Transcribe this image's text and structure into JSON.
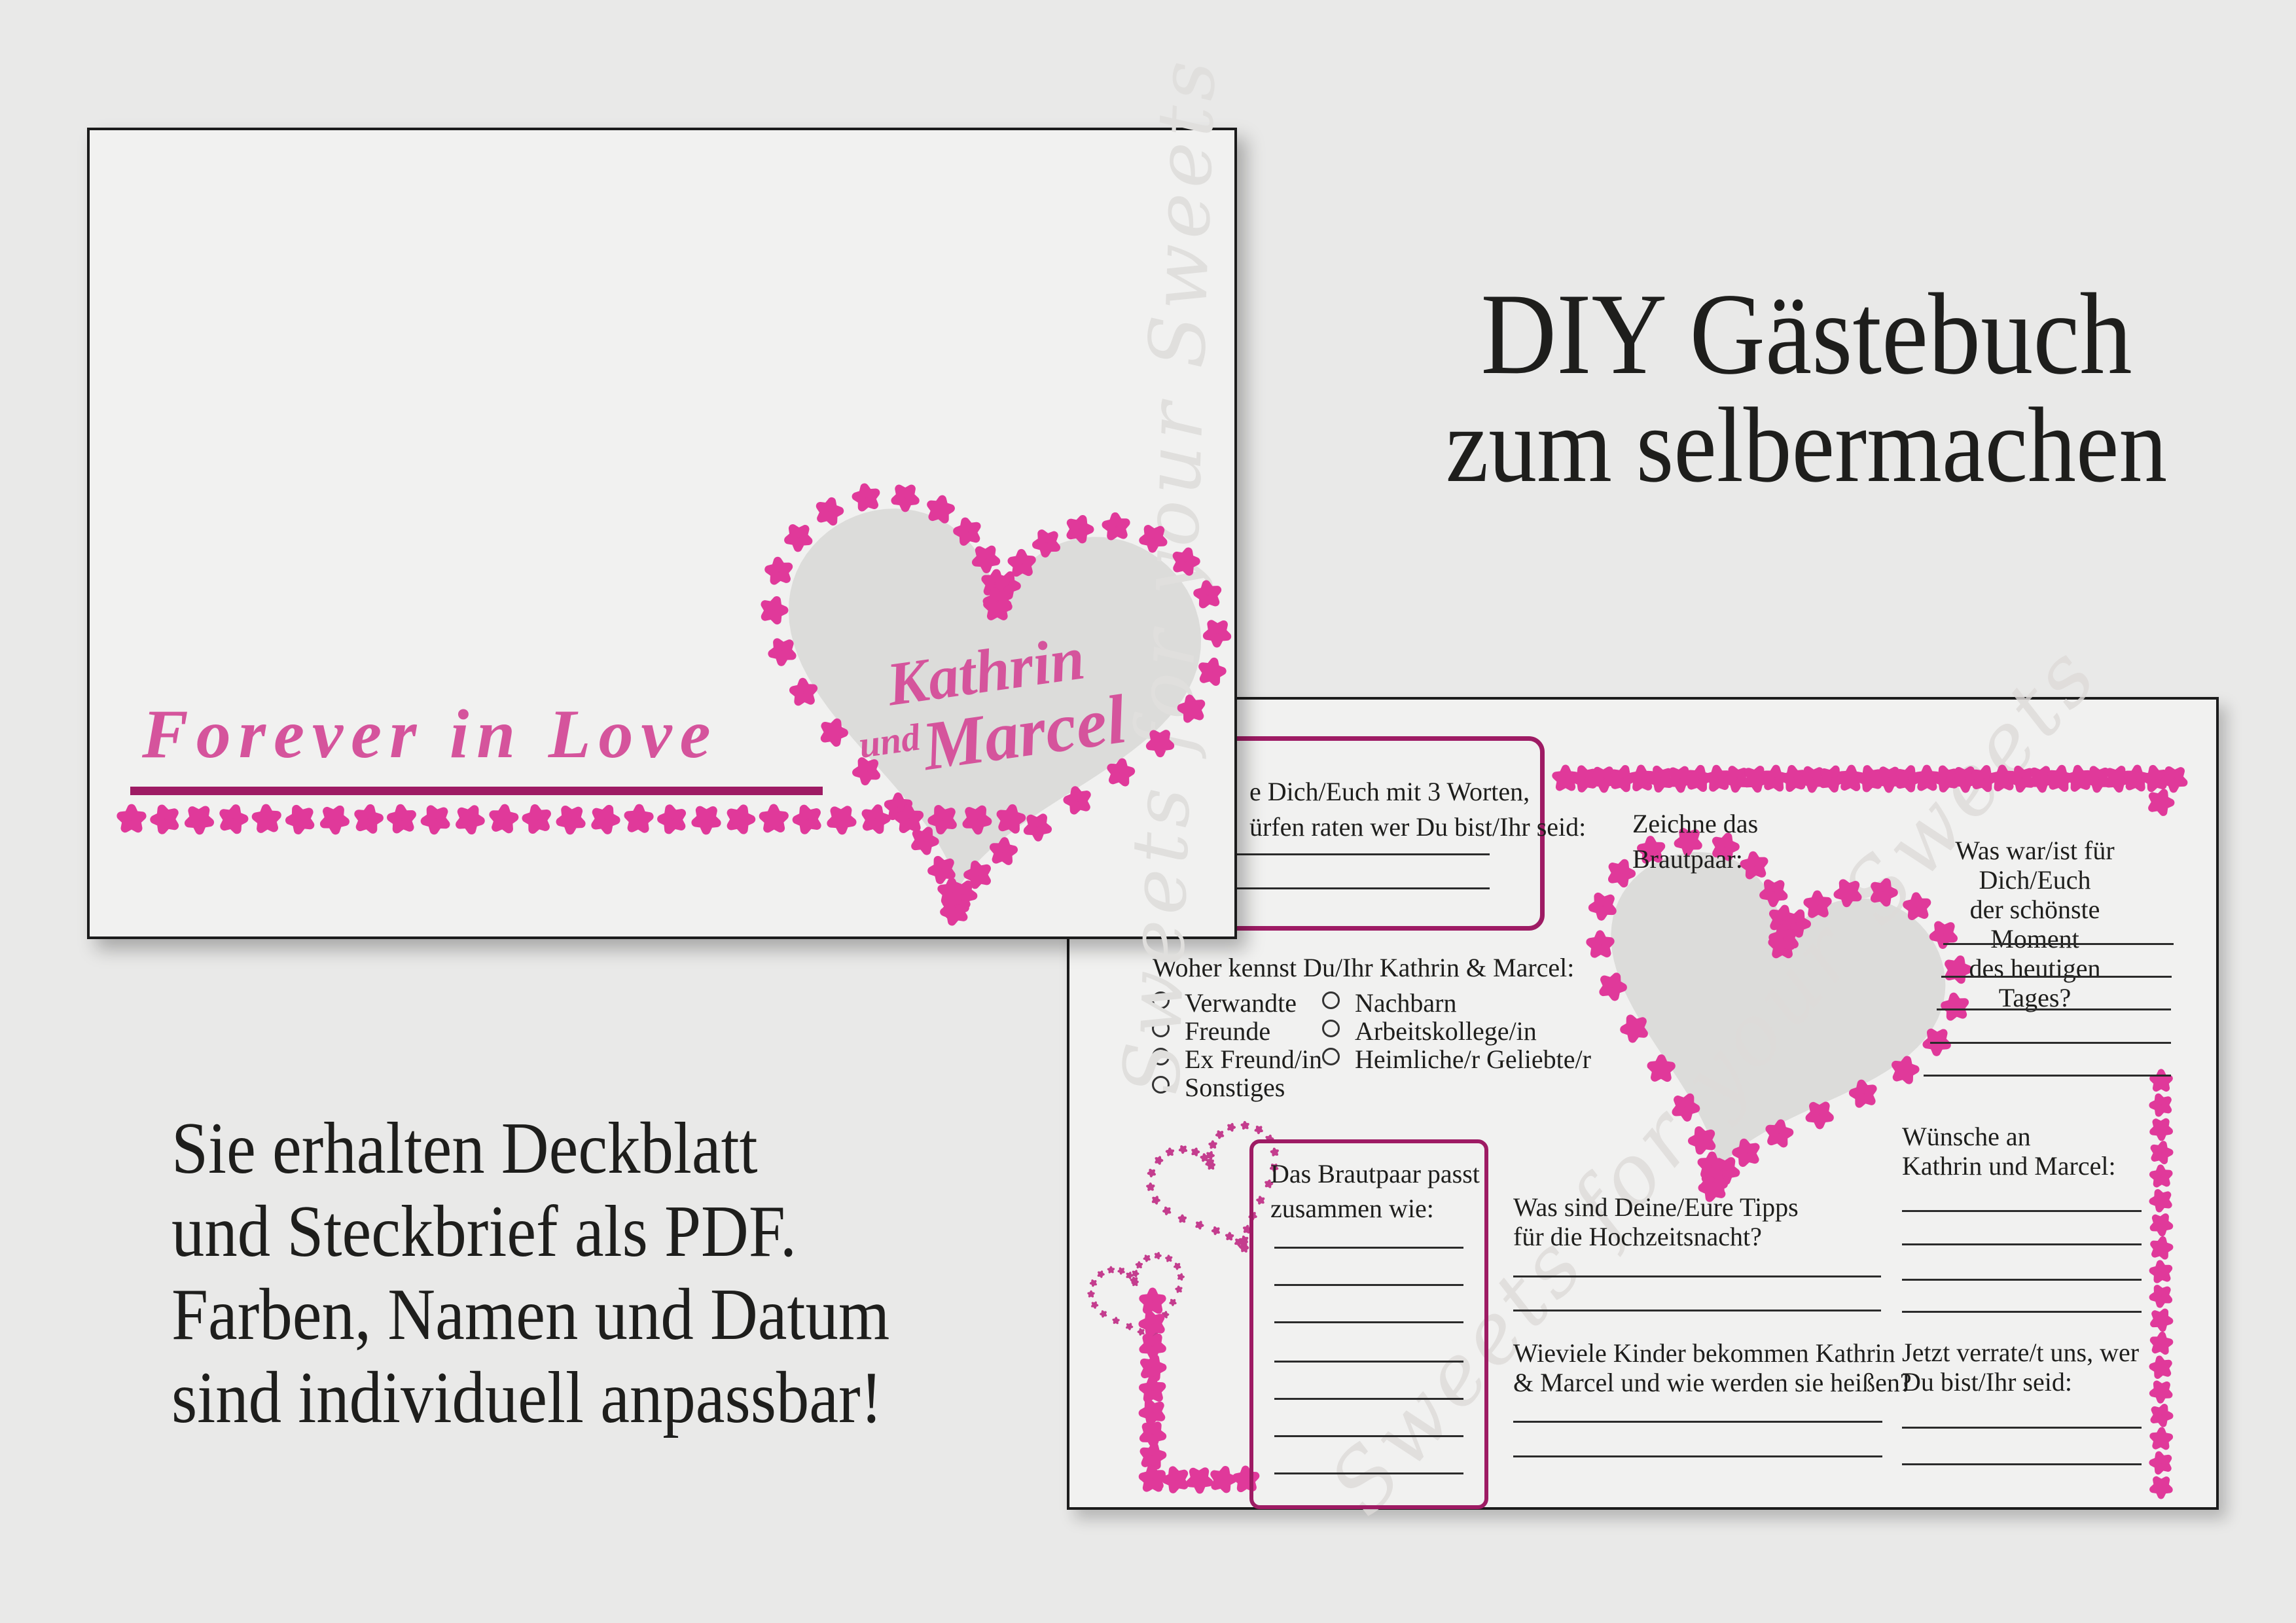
{
  "theme": {
    "bg": "#e9e9e8",
    "page_bg": "#f1f1f0",
    "star_pink": "#e0399a",
    "tiny_star_pink": "#c43d8e",
    "deep_magenta": "#9e1b64",
    "script_pink": "#d5549c",
    "heart_gray": "#dcdcda",
    "watermark_gray": "#dedbd9",
    "text": "#1e1e1c"
  },
  "headline": {
    "line1": "DIY Gästebuch",
    "line2": "zum selbermachen"
  },
  "note": {
    "lines": [
      "Sie erhalten Deckblatt",
      "und Steckbrief als PDF.",
      "Farben, Namen und Datum",
      "sind individuell anpassbar!"
    ]
  },
  "cover": {
    "title": "Forever in Love",
    "names": {
      "first": "Kathrin",
      "conj": "und",
      "second": "Marcel"
    },
    "watermark": "Sweets for your Sweets"
  },
  "form": {
    "watermark": "Sweets for your Sweets",
    "q_describe": {
      "line1": "e Dich/Euch mit 3 Worten,",
      "line2": "ürfen raten wer Du bist/Ihr seid:"
    },
    "q_draw": {
      "line1": "Zeichne das",
      "line2": "Brautpaar:"
    },
    "q_moment": {
      "line1": "Was war/ist für Dich/Euch",
      "line2": "der schönste Moment",
      "line3": "des heutigen Tages?"
    },
    "q_know": {
      "heading": "Woher kennst Du/Ihr Kathrin & Marcel:",
      "col1": [
        "Verwandte",
        "Freunde",
        "Ex Freund/in",
        "Sonstiges"
      ],
      "col2": [
        "Nachbarn",
        "Arbeitskollege/in",
        "Heimliche/r Geliebte/r"
      ]
    },
    "q_match": {
      "line1": "Das Brautpaar passt",
      "line2": "zusammen wie:"
    },
    "q_tips": {
      "line1": "Was sind Deine/Eure Tipps",
      "line2": "für die Hochzeitsnacht?"
    },
    "q_children": {
      "line1": "Wieviele Kinder bekommen Kathrin",
      "line2": "& Marcel und wie werden sie heißen?"
    },
    "q_wishes": {
      "line1": "Wünsche an",
      "line2": "Kathrin und Marcel:"
    },
    "q_reveal": {
      "line1": "Jetzt verrate/t uns, wer",
      "line2": "Du bist/Ihr seid:"
    }
  }
}
